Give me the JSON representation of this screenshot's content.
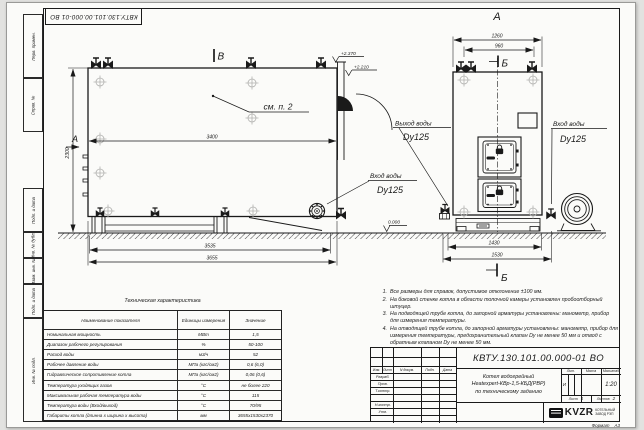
{
  "sheet": {
    "designation_stamp": "КВТУ.130.101.00.000-01 ВО",
    "format_label": "Формат",
    "format_value": "А3",
    "margin_labels": [
      "Перв. примен.",
      "Справ. №",
      "Подп. и дата",
      "Инв. № дубл.",
      "Взам. инв. №",
      "Подп. и дата",
      "Инв. № подл."
    ]
  },
  "drawing": {
    "front": {
      "section_mark": "В",
      "view_mark": "А",
      "callout": "см. п. 2",
      "dim_mid": "3400",
      "dim_height": "2300",
      "dim_base": "3535",
      "dim_total": "3655",
      "elev_top": "+2.370",
      "elev_mid": "+2.210",
      "inlet_title": "Вход воды",
      "inlet_size": "Dy125"
    },
    "side": {
      "view_title": "А",
      "section_top": "Б",
      "section_bottom": "Б",
      "dim_top": "1260",
      "dim_inner": "960",
      "dim_base": "1430",
      "dim_total": "1530",
      "elev_zero": "0.000",
      "outlet_title": "Выход воды",
      "outlet_size": "Dy125",
      "inlet_title": "Вход воды",
      "inlet_size": "Dy125"
    }
  },
  "notes": {
    "items": [
      {
        "num": "1.",
        "text": "Все размеры для справок, допустимое отклонение ±100 мм."
      },
      {
        "num": "2.",
        "text": "На боковой стенке котла в области топочной камеры установлен пробоотборный штуцер."
      },
      {
        "num": "3.",
        "text": "На подводящей трубе котла, до запорной арматуры установлены: манометр, прибор для измерения температуры."
      },
      {
        "num": "4.",
        "text": "На отводящей трубе котла, до запорной арматуры установлены: манометр, прибор для измерения температуры, предохранительный клапан Dу не менее 50 мм и отвод с обратным клапаном Dу не менее 50 мм."
      }
    ]
  },
  "tech_table": {
    "title": "Техническая характеристика",
    "col_name": "Наименование показателя",
    "col_unit": "Единицы измерения",
    "col_value": "Значение",
    "rows": [
      {
        "name": "Номинальная мощность",
        "unit": "МВт",
        "value": "1,5"
      },
      {
        "name": "Диапазон рабочего регулирования",
        "unit": "%",
        "value": "50-100"
      },
      {
        "name": "Расход воды",
        "unit": "м3/ч",
        "value": "52"
      },
      {
        "name": "Рабочее давление воды",
        "unit": "МПа (кгс/см2)",
        "value": "0,6 (6,0)"
      },
      {
        "name": "Гидравлическое сопротивление котла",
        "unit": "МПа (кгс/см2)",
        "value": "0,06 (0,6)"
      },
      {
        "name": "Температура уходящих газов",
        "unit": "°С",
        "value": "не более 220"
      },
      {
        "name": "Максимальная рабочая температура воды",
        "unit": "°С",
        "value": "115"
      },
      {
        "name": "Температура воды (Вход/выход)",
        "unit": "°С",
        "value": "70/95"
      },
      {
        "name": "Габариты котла (длинна х ширина х высота)",
        "unit": "мм",
        "value": "3655х1530х2370"
      }
    ]
  },
  "title_block": {
    "designation": "КВТУ.130.101.00.000-01 ВО",
    "name_line1": "Котел водогрейный",
    "name_line2": "Heatexpert-КВр-1,5-КБД(РВР)",
    "name_line3": "по техническому заданию",
    "col_izm": "Изм.",
    "col_list": "Лист",
    "col_doc": "N докум.",
    "col_sign": "Подп.",
    "col_date": "Дата",
    "row_razrab": "Разраб.",
    "row_prov": "Пров.",
    "row_tkontr": "Т.контр.",
    "row_nkontr": "Н.контр.",
    "row_utv": "Утв.",
    "lit_label": "Лит.",
    "mass_label": "Масса",
    "scale_label": "Масштаб",
    "lit_value": "И",
    "scale_value": "1:20",
    "sheet_label": "Лист",
    "sheet_value": "1",
    "sheets_label": "Листов",
    "sheets_value": "2",
    "company_logo": "KVZR",
    "company_line1": "КОТЕЛЬНЫЙ",
    "company_line2": "ЗАВОД РЭП"
  }
}
